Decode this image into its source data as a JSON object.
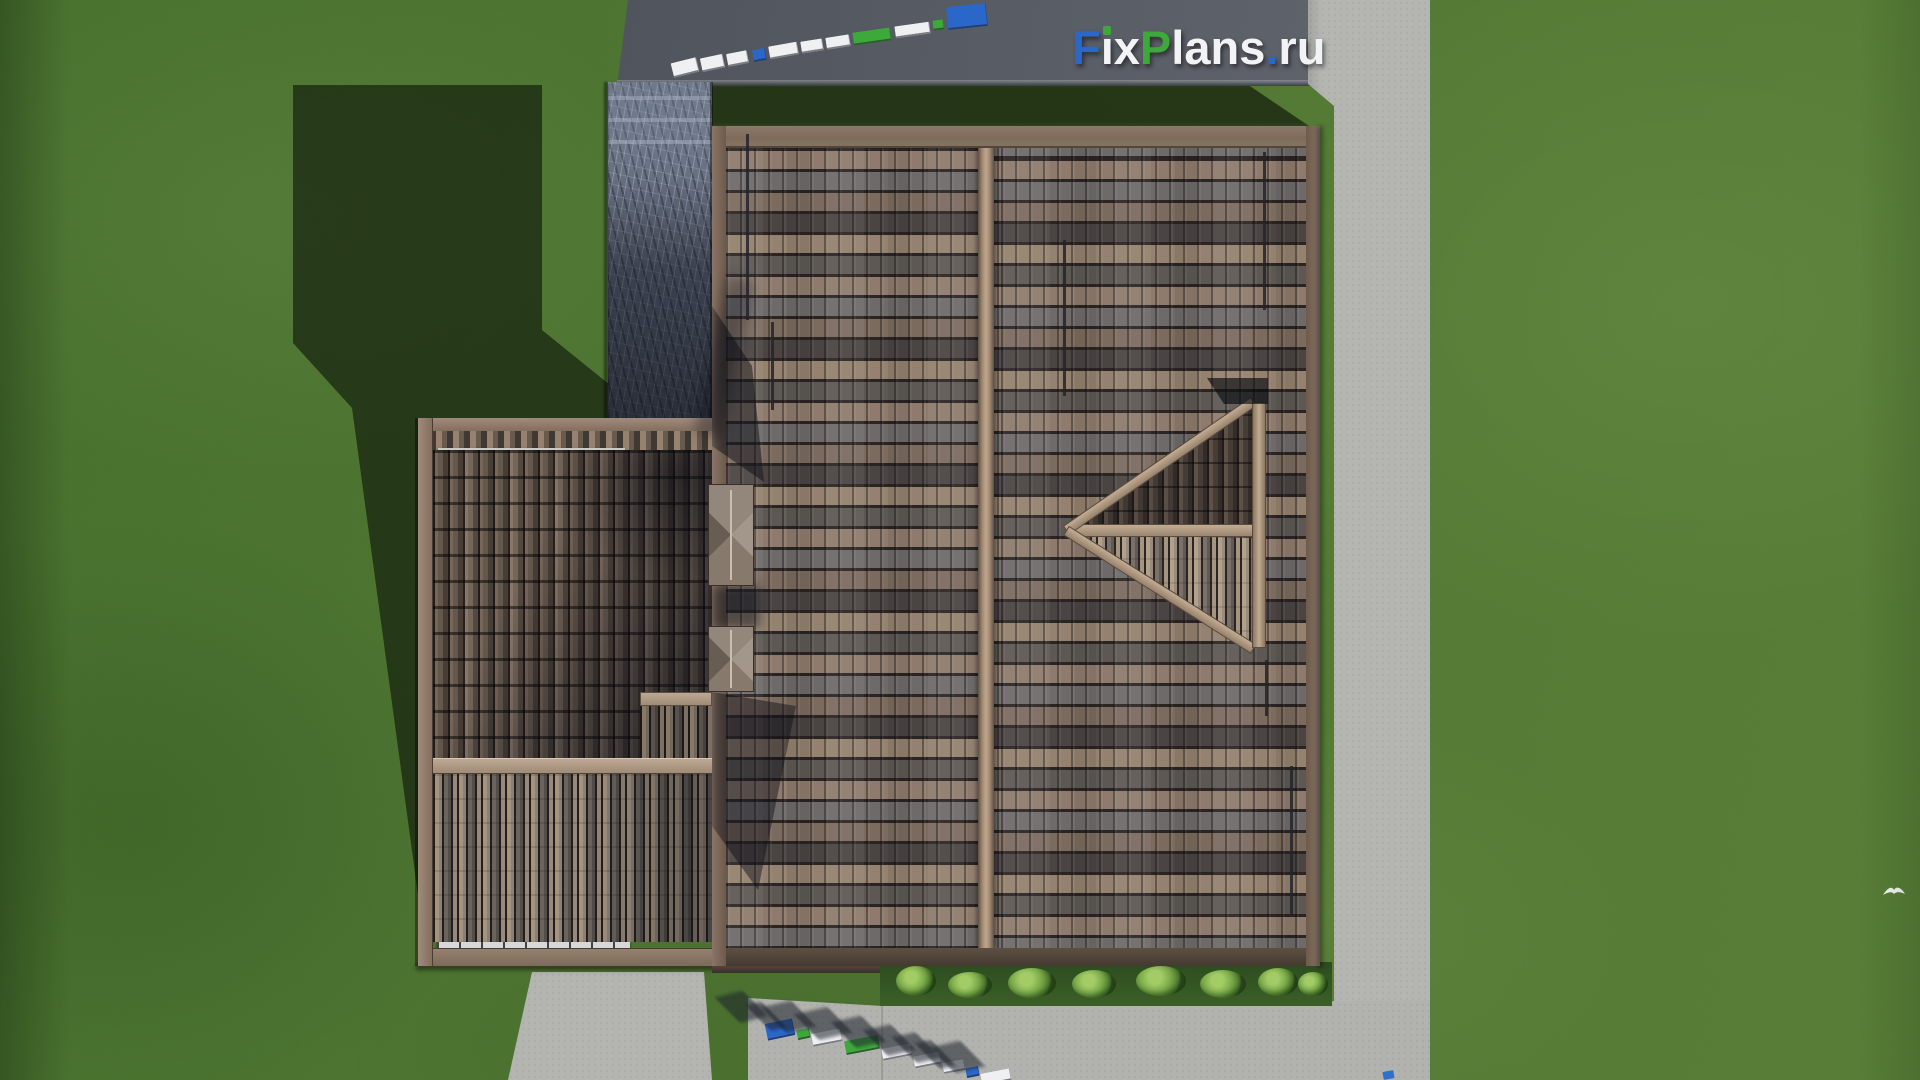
{
  "watermark": {
    "text": "FixPlans.ru",
    "letters": [
      {
        "ch": "F",
        "color": "#2b67c9"
      },
      {
        "ch": "i",
        "color": "#f2f3f5",
        "dot": "#3ea93b"
      },
      {
        "ch": "x",
        "color": "#f2f3f5"
      },
      {
        "ch": "P",
        "color": "#3ea93b"
      },
      {
        "ch": "l",
        "color": "#f2f3f5"
      },
      {
        "ch": "a",
        "color": "#f2f3f5"
      },
      {
        "ch": "n",
        "color": "#f2f3f5"
      },
      {
        "ch": "s",
        "color": "#f2f3f5"
      },
      {
        "ch": ".",
        "color": "#2b67c9"
      },
      {
        "ch": "r",
        "color": "#f2f3f5"
      },
      {
        "ch": "u",
        "color": "#f2f3f5"
      }
    ]
  },
  "palette": {
    "brand_blue": "#2b67c9",
    "brand_green": "#3ea93b",
    "letter_white": "#eef0f2",
    "grass": "#4f7631",
    "road": "#575b63",
    "sidewalk": "#b5b6b2",
    "concrete_path": "#b3b4b0",
    "roof_tile_brown": "#8e7b6d",
    "roof_tile_gray": "#6e6a69",
    "roof_tile_dark": "#4a4443",
    "ridge_tan": "#c0a68b",
    "stone_driveway": "#667083",
    "shadow_green": "rgba(12,17,8,0.6)"
  },
  "scene": {
    "top_letter_blocks": [
      {
        "x": 672,
        "y": 60,
        "w": 26,
        "h": 15,
        "c": "letter_white",
        "r": -14
      },
      {
        "x": 701,
        "y": 56,
        "w": 23,
        "h": 14,
        "c": "letter_white",
        "r": -12
      },
      {
        "x": 727,
        "y": 52,
        "w": 21,
        "h": 13,
        "c": "letter_white",
        "r": -11
      },
      {
        "x": 753,
        "y": 49,
        "w": 13,
        "h": 12,
        "c": "brand_blue",
        "r": -11
      },
      {
        "x": 769,
        "y": 44,
        "w": 29,
        "h": 13,
        "c": "letter_white",
        "r": -10
      },
      {
        "x": 801,
        "y": 40,
        "w": 22,
        "h": 12,
        "c": "letter_white",
        "r": -9
      },
      {
        "x": 826,
        "y": 36,
        "w": 24,
        "h": 12,
        "c": "letter_white",
        "r": -9
      },
      {
        "x": 853,
        "y": 30,
        "w": 38,
        "h": 13,
        "c": "brand_green",
        "r": -8
      },
      {
        "x": 895,
        "y": 24,
        "w": 35,
        "h": 12,
        "c": "letter_white",
        "r": -8
      },
      {
        "x": 933,
        "y": 20,
        "w": 11,
        "h": 10,
        "c": "brand_green",
        "r": -8
      },
      {
        "x": 947,
        "y": 5,
        "w": 40,
        "h": 23,
        "c": "brand_blue",
        "r": -6
      }
    ],
    "bottom_letter_blocks": [
      {
        "x": 766,
        "y": 1021,
        "w": 28,
        "h": 17,
        "c": "brand_blue",
        "r": -12
      },
      {
        "x": 797,
        "y": 1029,
        "w": 13,
        "h": 10,
        "c": "brand_green",
        "r": -12
      },
      {
        "x": 812,
        "y": 1031,
        "w": 30,
        "h": 13,
        "c": "letter_white",
        "r": -11
      },
      {
        "x": 845,
        "y": 1038,
        "w": 34,
        "h": 14,
        "c": "brand_green",
        "r": -11
      },
      {
        "x": 882,
        "y": 1046,
        "w": 30,
        "h": 12,
        "c": "letter_white",
        "r": -11
      },
      {
        "x": 914,
        "y": 1054,
        "w": 27,
        "h": 12,
        "c": "letter_white",
        "r": -11
      },
      {
        "x": 943,
        "y": 1061,
        "w": 22,
        "h": 11,
        "c": "letter_white",
        "r": -11
      },
      {
        "x": 966,
        "y": 1067,
        "w": 13,
        "h": 10,
        "c": "brand_blue",
        "r": -11
      },
      {
        "x": 981,
        "y": 1071,
        "w": 30,
        "h": 12,
        "c": "letter_white",
        "r": -11
      }
    ],
    "bushes": [
      {
        "x": 896,
        "y": 966,
        "w": 40,
        "h": 30
      },
      {
        "x": 948,
        "y": 972,
        "w": 44,
        "h": 26
      },
      {
        "x": 1008,
        "y": 968,
        "w": 48,
        "h": 30
      },
      {
        "x": 1072,
        "y": 970,
        "w": 44,
        "h": 28
      },
      {
        "x": 1136,
        "y": 966,
        "w": 50,
        "h": 30
      },
      {
        "x": 1200,
        "y": 970,
        "w": 46,
        "h": 28
      },
      {
        "x": 1258,
        "y": 968,
        "w": 40,
        "h": 28
      },
      {
        "x": 1298,
        "y": 972,
        "w": 30,
        "h": 24
      }
    ],
    "drive_steps_y": [
      96,
      118,
      140
    ],
    "pipes": [
      {
        "x": 34,
        "y": 8,
        "h": 186
      },
      {
        "x": 59,
        "y": 196,
        "h": 88
      },
      {
        "x": 551,
        "y": 26,
        "h": 158
      },
      {
        "x": 553,
        "y": 534,
        "h": 56
      },
      {
        "x": 578,
        "y": 640,
        "h": 148
      },
      {
        "x": 351,
        "y": 114,
        "h": 156
      }
    ],
    "bird": {
      "x": 1882,
      "y": 884,
      "color": "#f3f5f7"
    },
    "sidewalk_mark": {
      "x": 1383,
      "y": 1071,
      "w": 11,
      "h": 8,
      "color": "#2f6fd0"
    }
  }
}
